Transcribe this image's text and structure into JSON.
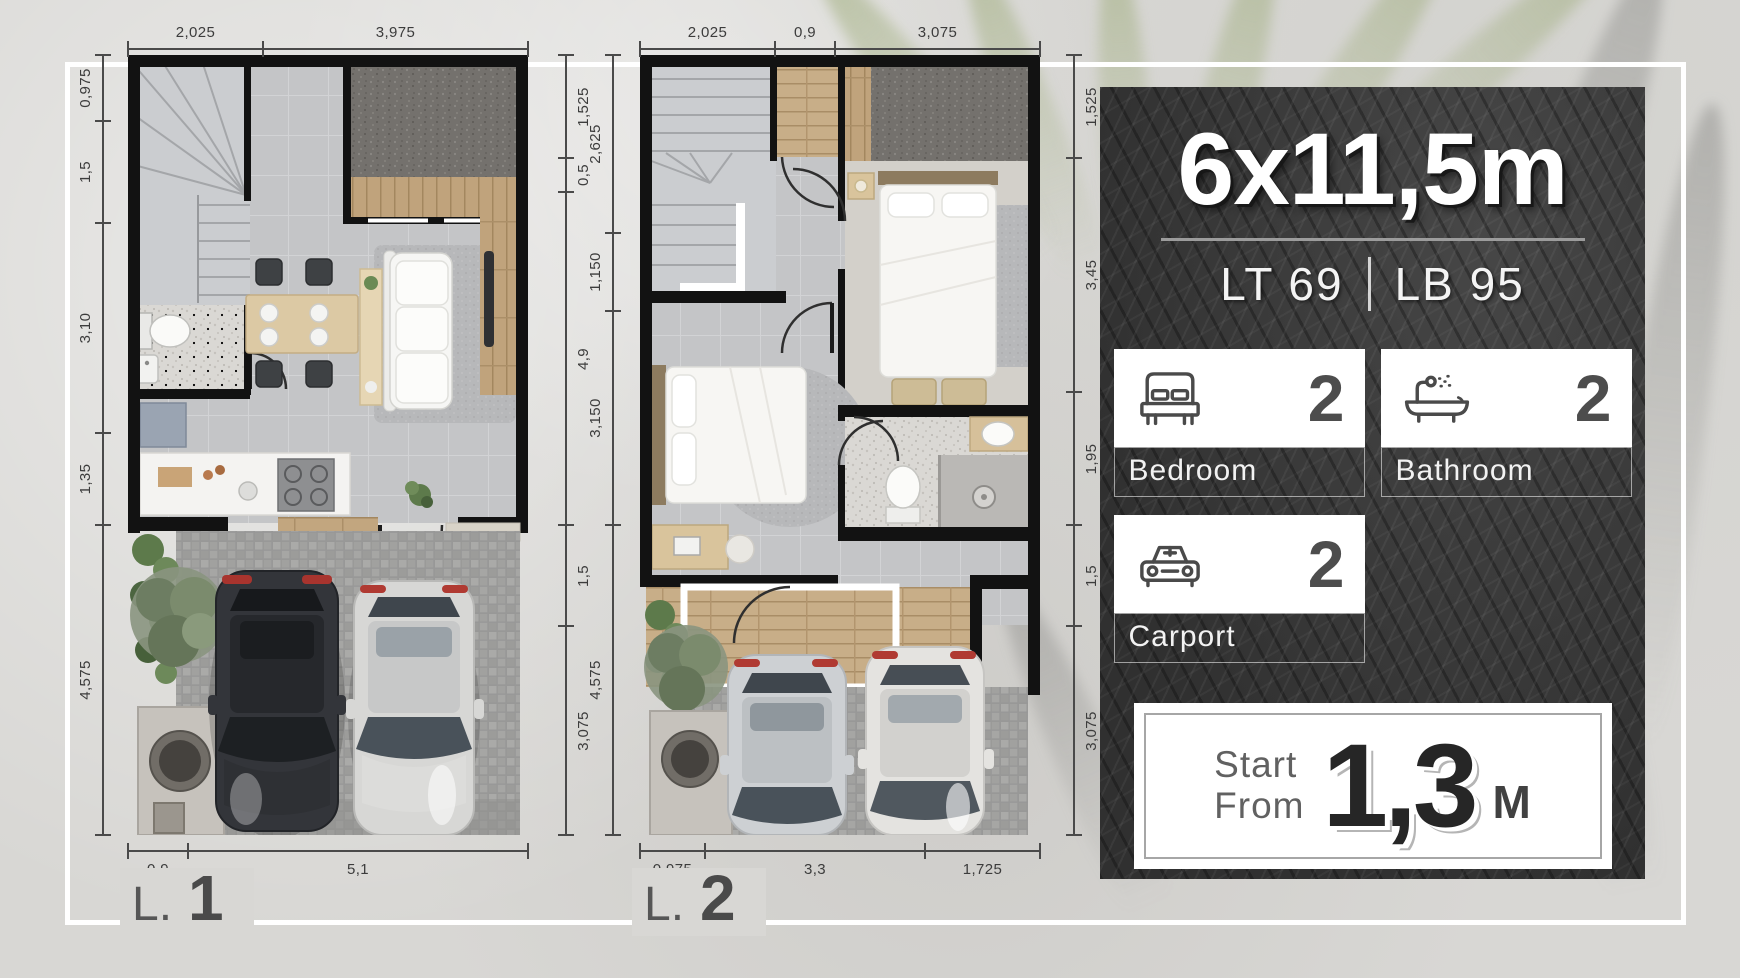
{
  "background": {
    "color": "#d8d7d4",
    "frame_color": "#ffffff"
  },
  "panel": {
    "bg": "#3a3a3a",
    "title": "6x11,5m",
    "lot": "LT 69",
    "building": "LB 95",
    "features": [
      {
        "icon": "bed-icon",
        "count": "2",
        "label": "Bedroom"
      },
      {
        "icon": "bathtub-icon",
        "count": "2",
        "label": "Bathroom"
      },
      {
        "icon": "car-icon",
        "count": "2",
        "label": "Carport"
      }
    ],
    "price": {
      "prefix_line1": "Start",
      "prefix_line2": "From",
      "value": "1,3",
      "unit": "M"
    }
  },
  "plans": [
    {
      "label": "L.",
      "number": "1",
      "dims": {
        "top": [
          {
            "v": "2,025",
            "m": 2.025
          },
          {
            "v": "3,975",
            "m": 3.975
          }
        ],
        "left": [
          {
            "v": "0,975",
            "m": 0.975
          },
          {
            "v": "1,5",
            "m": 1.5
          },
          {
            "v": "3,10",
            "m": 3.1
          },
          {
            "v": "1,35",
            "m": 1.35
          },
          {
            "v": "4,575",
            "m": 4.575
          }
        ],
        "right": [
          {
            "v": "1,525",
            "m": 1.525
          },
          {
            "v": "0,5",
            "m": 0.5
          },
          {
            "v": "4,9",
            "m": 4.9
          },
          {
            "v": "1,5",
            "m": 1.5
          },
          {
            "v": "3,075",
            "m": 3.075
          }
        ],
        "bottom": [
          {
            "v": "0,9",
            "m": 0.9
          },
          {
            "v": "5,1",
            "m": 5.1
          }
        ]
      }
    },
    {
      "label": "L.",
      "number": "2",
      "dims": {
        "top": [
          {
            "v": "2,025",
            "m": 2.025
          },
          {
            "v": "0,9",
            "m": 0.9
          },
          {
            "v": "3,075",
            "m": 3.075
          }
        ],
        "left": [
          {
            "v": "2,625",
            "m": 2.625
          },
          {
            "v": "1,150",
            "m": 1.15
          },
          {
            "v": "3,150",
            "m": 3.15
          },
          {
            "v": "4,575",
            "m": 4.575
          }
        ],
        "right": [
          {
            "v": "1,525",
            "m": 1.525
          },
          {
            "v": "3,45",
            "m": 3.45
          },
          {
            "v": "1,95",
            "m": 1.95
          },
          {
            "v": "1,5",
            "m": 1.5
          },
          {
            "v": "3,075",
            "m": 3.075
          }
        ],
        "bottom": [
          {
            "v": "0,975",
            "m": 0.975
          },
          {
            "v": "3,3",
            "m": 3.3
          },
          {
            "v": "1,725",
            "m": 1.725
          }
        ]
      }
    }
  ]
}
